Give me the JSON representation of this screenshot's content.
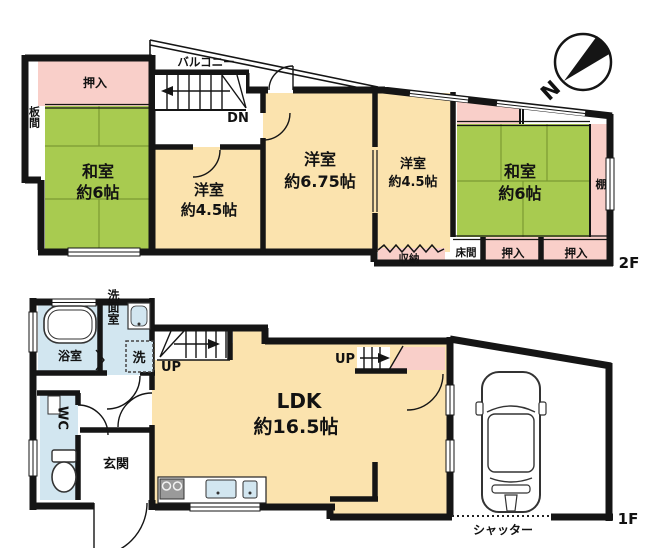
{
  "plan": {
    "floor2": {
      "floor_label": "2F",
      "balcony": "バルコニー",
      "stairs_down": "DN",
      "oshiire_top": "押入",
      "itanoma": "板間",
      "washitsu_left_name": "和室",
      "washitsu_left_size": "約6帖",
      "youshitsu_mid_name": "洋室",
      "youshitsu_mid_size": "約4.5帖",
      "youshitsu_large_name": "洋室",
      "youshitsu_large_size": "約6.75帖",
      "youshitsu_right_name": "洋室",
      "youshitsu_right_size": "約4.5帖",
      "washitsu_right_name": "和室",
      "washitsu_right_size": "約6帖",
      "tana": "棚",
      "shuunou": "収納",
      "tokonoma": "床間",
      "oshiire_mid": "押入",
      "oshiire_right": "押入"
    },
    "floor1": {
      "floor_label": "1F",
      "bathroom": "浴室",
      "washroom": "洗面室",
      "washer": "洗",
      "toilet": "WC",
      "entrance": "玄関",
      "ldk_name": "LDK",
      "ldk_size": "約16.5帖",
      "stairs_up_left": "UP",
      "stairs_up_right": "UP",
      "shutter": "シャッター"
    },
    "compass_n": "N"
  },
  "colors": {
    "tatami_green": "#a8cb50",
    "room_cream": "#fbe3ae",
    "closet_pink": "#f9cfc9",
    "wet_blue": "#d2e6f0",
    "wall_black": "#151515"
  }
}
